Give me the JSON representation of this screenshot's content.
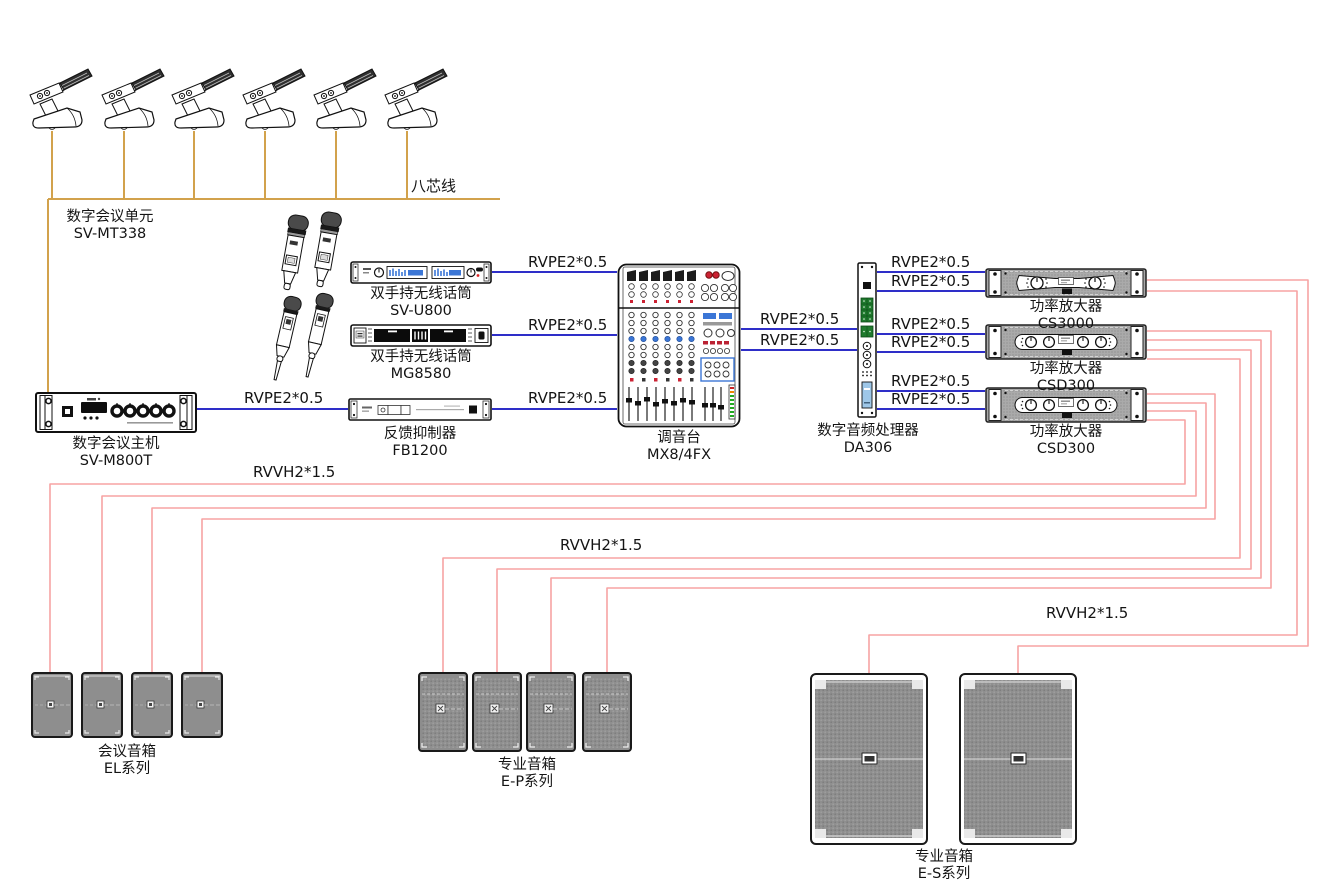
{
  "cable_labels": {
    "eight_core": "八芯线",
    "rvpe": "RVPE2*0.5",
    "rvvh": "RVVH2*1.5"
  },
  "devices": {
    "conference_unit": {
      "name": "数字会议单元",
      "model": "SV-MT338"
    },
    "wireless_mic_u800": {
      "name": "双手持无线话筒",
      "model": "SV-U800"
    },
    "wireless_mic_mg8580": {
      "name": "双手持无线话筒",
      "model": "MG8580"
    },
    "conference_host": {
      "name": "数字会议主机",
      "model": "SV-M800T"
    },
    "feedback_suppressor": {
      "name": "反馈抑制器",
      "model": "FB1200"
    },
    "mixer": {
      "name": "调音台",
      "model": "MX8/4FX"
    },
    "audio_processor": {
      "name": "数字音频处理器",
      "model": "DA306"
    },
    "amplifier_1": {
      "name": "功率放大器",
      "model": "CS3000"
    },
    "amplifier_2": {
      "name": "功率放大器",
      "model": "CSD300"
    },
    "amplifier_3": {
      "name": "功率放大器",
      "model": "CSD300"
    },
    "conference_speakers": {
      "name": "会议音箱",
      "model": "EL系列"
    },
    "pro_speakers_ep": {
      "name": "专业音箱",
      "model": "E-P系列"
    },
    "pro_speakers_es": {
      "name": "专业音箱",
      "model": "E-S系列"
    }
  },
  "colors": {
    "bus_line": "#D2A24C",
    "signal_line": "#2E2EC8",
    "speaker_line": "#F7A3A3"
  }
}
